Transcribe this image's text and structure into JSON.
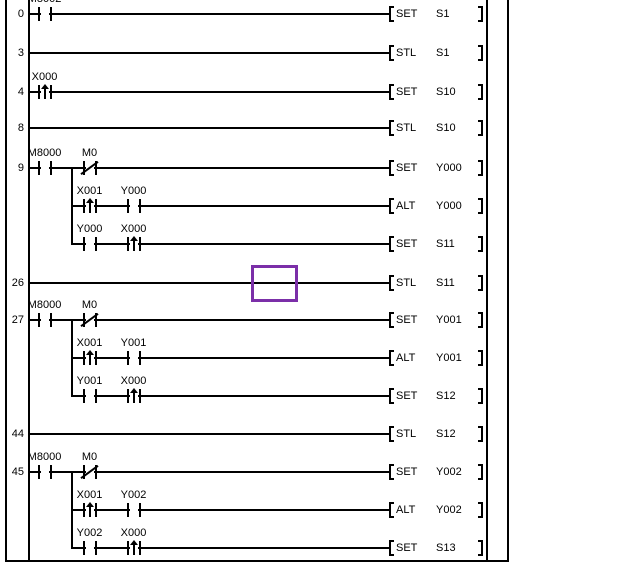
{
  "editor": {
    "type": "plc-ladder-editor",
    "background": "#FFFFFF",
    "line_color": "#000000",
    "cursor": {
      "row": 7,
      "color": "#7B2FA8"
    },
    "rows": [
      {
        "step": "0",
        "start": "rail",
        "contacts": [
          {
            "col": 1,
            "type": "no",
            "label": "M8002"
          }
        ],
        "instruction": {
          "mnemonic": "SET",
          "operand": "S1"
        }
      },
      {
        "step": "3",
        "start": "rail",
        "contacts": [],
        "instruction": {
          "mnemonic": "STL",
          "operand": "S1"
        }
      },
      {
        "step": "4",
        "start": "rail",
        "contacts": [
          {
            "col": 1,
            "type": "pulse",
            "label": "X000"
          }
        ],
        "instruction": {
          "mnemonic": "SET",
          "operand": "S10"
        }
      },
      {
        "step": "8",
        "start": "rail",
        "contacts": [],
        "instruction": {
          "mnemonic": "STL",
          "operand": "S10"
        }
      },
      {
        "step": "9",
        "start": "rail",
        "contacts": [
          {
            "col": 1,
            "type": "no",
            "label": "M8000"
          },
          {
            "col": 2,
            "type": "nc",
            "label": "M0"
          }
        ],
        "instruction": {
          "mnemonic": "SET",
          "operand": "Y000"
        }
      },
      {
        "start": "branch",
        "contacts": [
          {
            "col": 2,
            "type": "pulse",
            "label": "X001"
          },
          {
            "col": 3,
            "type": "no",
            "label": "Y000"
          }
        ],
        "instruction": {
          "mnemonic": "ALT",
          "operand": "Y000"
        }
      },
      {
        "start": "branch",
        "contacts": [
          {
            "col": 2,
            "type": "no",
            "label": "Y000"
          },
          {
            "col": 3,
            "type": "pulse",
            "label": "X000"
          }
        ],
        "instruction": {
          "mnemonic": "SET",
          "operand": "S11"
        }
      },
      {
        "step": "26",
        "start": "rail",
        "contacts": [],
        "instruction": {
          "mnemonic": "STL",
          "operand": "S11"
        }
      },
      {
        "step": "27",
        "start": "rail",
        "contacts": [
          {
            "col": 1,
            "type": "no",
            "label": "M8000"
          },
          {
            "col": 2,
            "type": "nc",
            "label": "M0"
          }
        ],
        "instruction": {
          "mnemonic": "SET",
          "operand": "Y001"
        }
      },
      {
        "start": "branch",
        "contacts": [
          {
            "col": 2,
            "type": "pulse",
            "label": "X001"
          },
          {
            "col": 3,
            "type": "no",
            "label": "Y001"
          }
        ],
        "instruction": {
          "mnemonic": "ALT",
          "operand": "Y001"
        }
      },
      {
        "start": "branch",
        "contacts": [
          {
            "col": 2,
            "type": "no",
            "label": "Y001"
          },
          {
            "col": 3,
            "type": "pulse",
            "label": "X000"
          }
        ],
        "instruction": {
          "mnemonic": "SET",
          "operand": "S12"
        }
      },
      {
        "step": "44",
        "start": "rail",
        "contacts": [],
        "instruction": {
          "mnemonic": "STL",
          "operand": "S12"
        }
      },
      {
        "step": "45",
        "start": "rail",
        "contacts": [
          {
            "col": 1,
            "type": "no",
            "label": "M8000"
          },
          {
            "col": 2,
            "type": "nc",
            "label": "M0"
          }
        ],
        "instruction": {
          "mnemonic": "SET",
          "operand": "Y002"
        }
      },
      {
        "start": "branch",
        "contacts": [
          {
            "col": 2,
            "type": "pulse",
            "label": "X001"
          },
          {
            "col": 3,
            "type": "no",
            "label": "Y002"
          }
        ],
        "instruction": {
          "mnemonic": "ALT",
          "operand": "Y002"
        }
      },
      {
        "start": "branch",
        "contacts": [
          {
            "col": 2,
            "type": "no",
            "label": "Y002"
          },
          {
            "col": 3,
            "type": "pulse",
            "label": "X000"
          }
        ],
        "instruction": {
          "mnemonic": "SET",
          "operand": "S13"
        }
      }
    ],
    "branches": [
      [
        4,
        6
      ],
      [
        8,
        10
      ],
      [
        12,
        14
      ]
    ]
  }
}
